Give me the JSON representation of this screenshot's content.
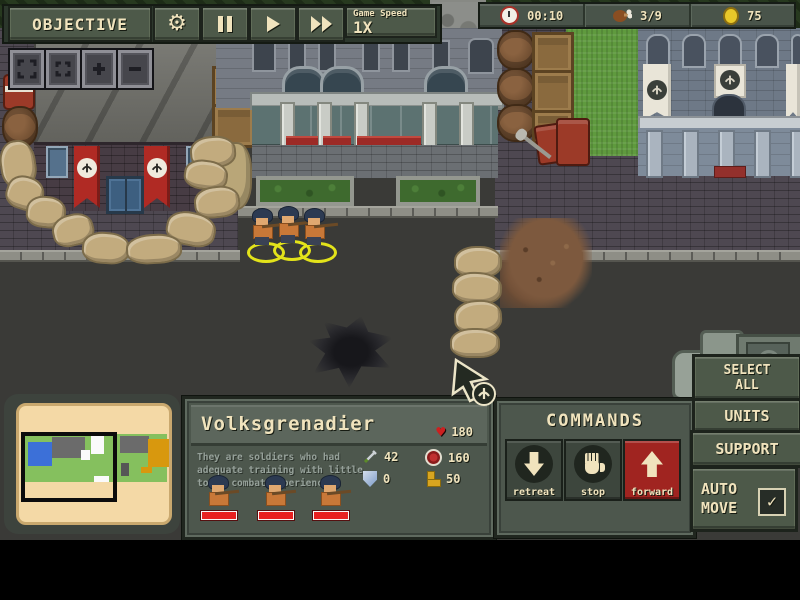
{
  "hud": {
    "objective": "OBJECTIVE",
    "game_speed_label": "Game Speed",
    "game_speed_value": "1X",
    "time": "00:10",
    "rations": "3/9",
    "gold": "75"
  },
  "unit_panel": {
    "name": "Volksgrenadier",
    "hp": "180",
    "description_lines": [
      "They are soldiers who had",
      "adequate training with little",
      "to no combat experience"
    ],
    "attack": "42",
    "range": "160",
    "armor": "0",
    "speed": "50"
  },
  "commands": {
    "title": "COMMANDS",
    "retreat_label": "retreat",
    "stop_label": "stop",
    "forward_label": "forward"
  },
  "side_buttons": {
    "select_all_line1": "SELECT",
    "select_all_line2": "ALL",
    "units": "UNITS",
    "support": "SUPPORT",
    "auto_line1": "AUTO",
    "auto_line2": "MOVE",
    "auto_move_checked": true,
    "checkmark": "✓"
  },
  "icons": [
    "gear-icon",
    "pause-icon",
    "play-icon",
    "fast-forward-icon",
    "clock-icon",
    "drumstick-icon",
    "coin-icon",
    "heart-icon",
    "sword-icon",
    "target-icon",
    "shield-icon",
    "boot-icon",
    "expand-view-icon",
    "center-view-icon",
    "zoom-in-icon",
    "zoom-out-icon",
    "retreat-arrow-icon",
    "stop-hand-icon",
    "forward-arrow-icon",
    "checkmark-icon",
    "cursor-icon"
  ],
  "colors": {
    "ui_olive": "#4d5949",
    "ui_panel": "#4d574d",
    "cream_text": "#f0e3bd",
    "banner_red": "#b02a24",
    "health_red": "#e82020",
    "selection_yellow": "#e3e31a",
    "grass_green": "#5f9a3e",
    "minimap_paper": "#f4d9a6",
    "road_asphalt": "#3a3a37",
    "forward_red": "#a02420"
  }
}
